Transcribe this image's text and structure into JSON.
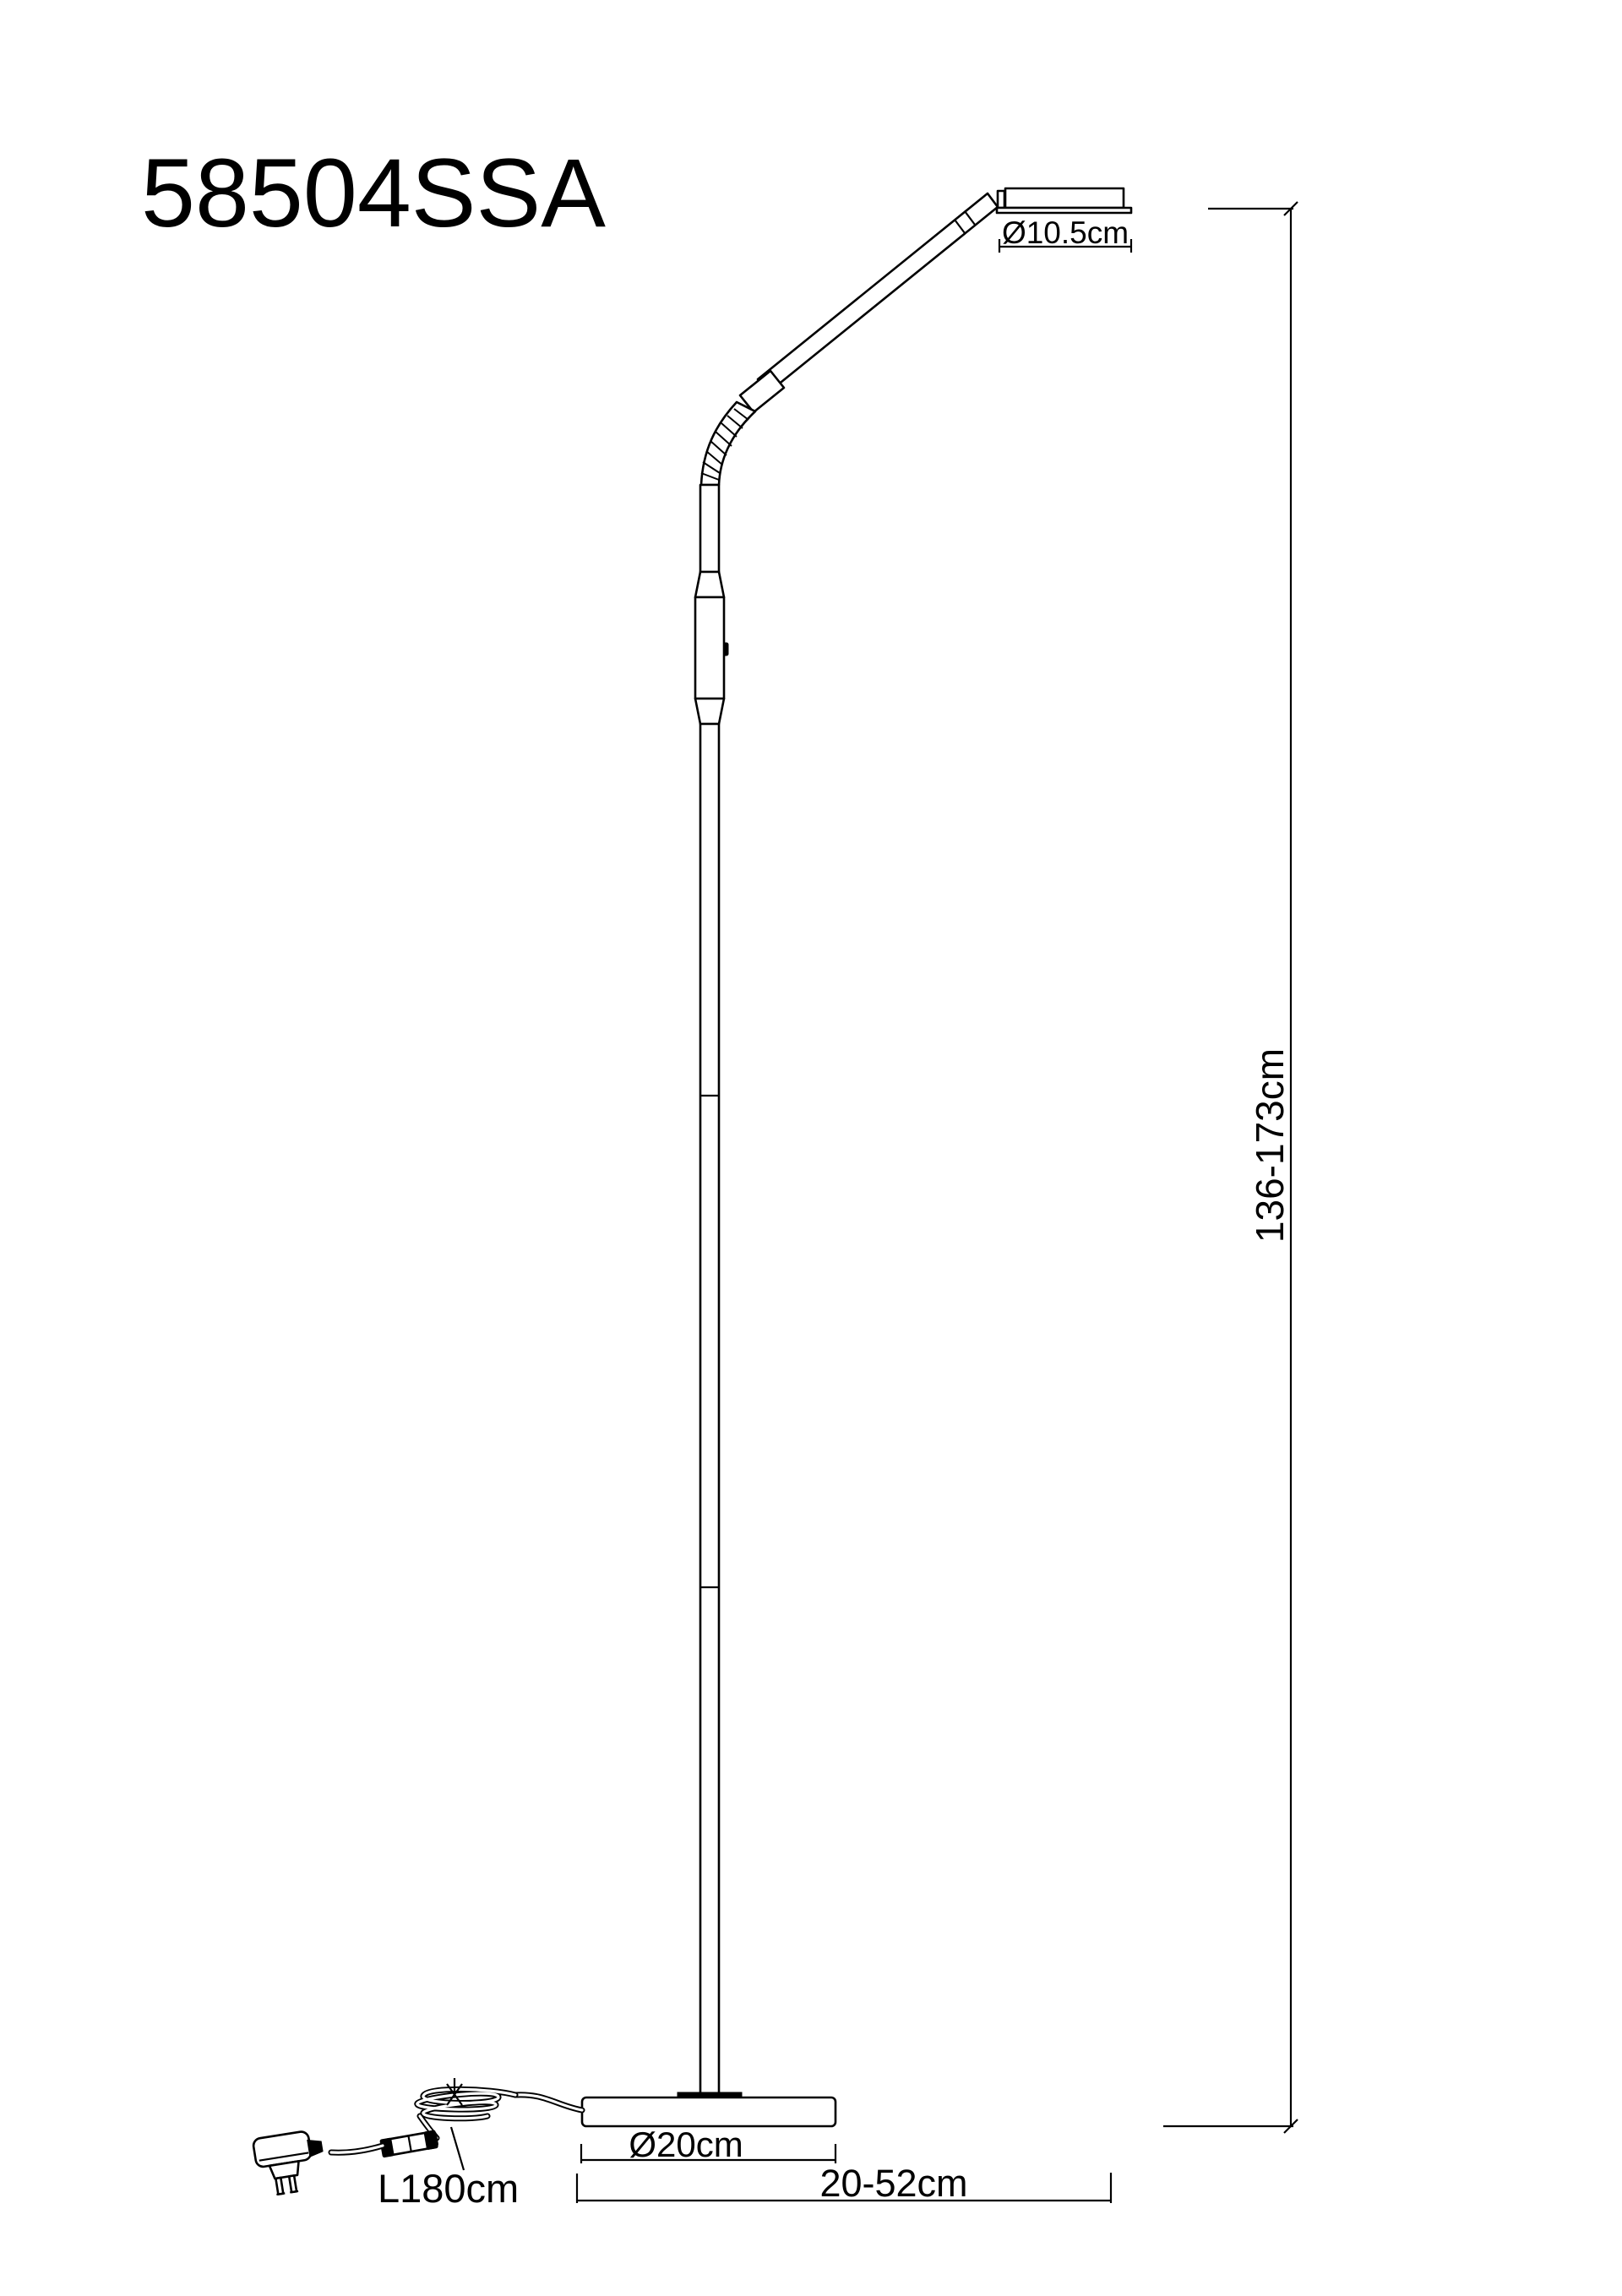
{
  "colors": {
    "background": "#ffffff",
    "line": "#000000",
    "text": "#000000"
  },
  "product": {
    "code": "58504SSA"
  },
  "dimensions": {
    "head_diameter": "Ø10.5cm",
    "height_range": "136-173cm",
    "base_diameter": "Ø20cm",
    "horizontal_reach": "20-52cm",
    "cable_length": "L180cm"
  }
}
